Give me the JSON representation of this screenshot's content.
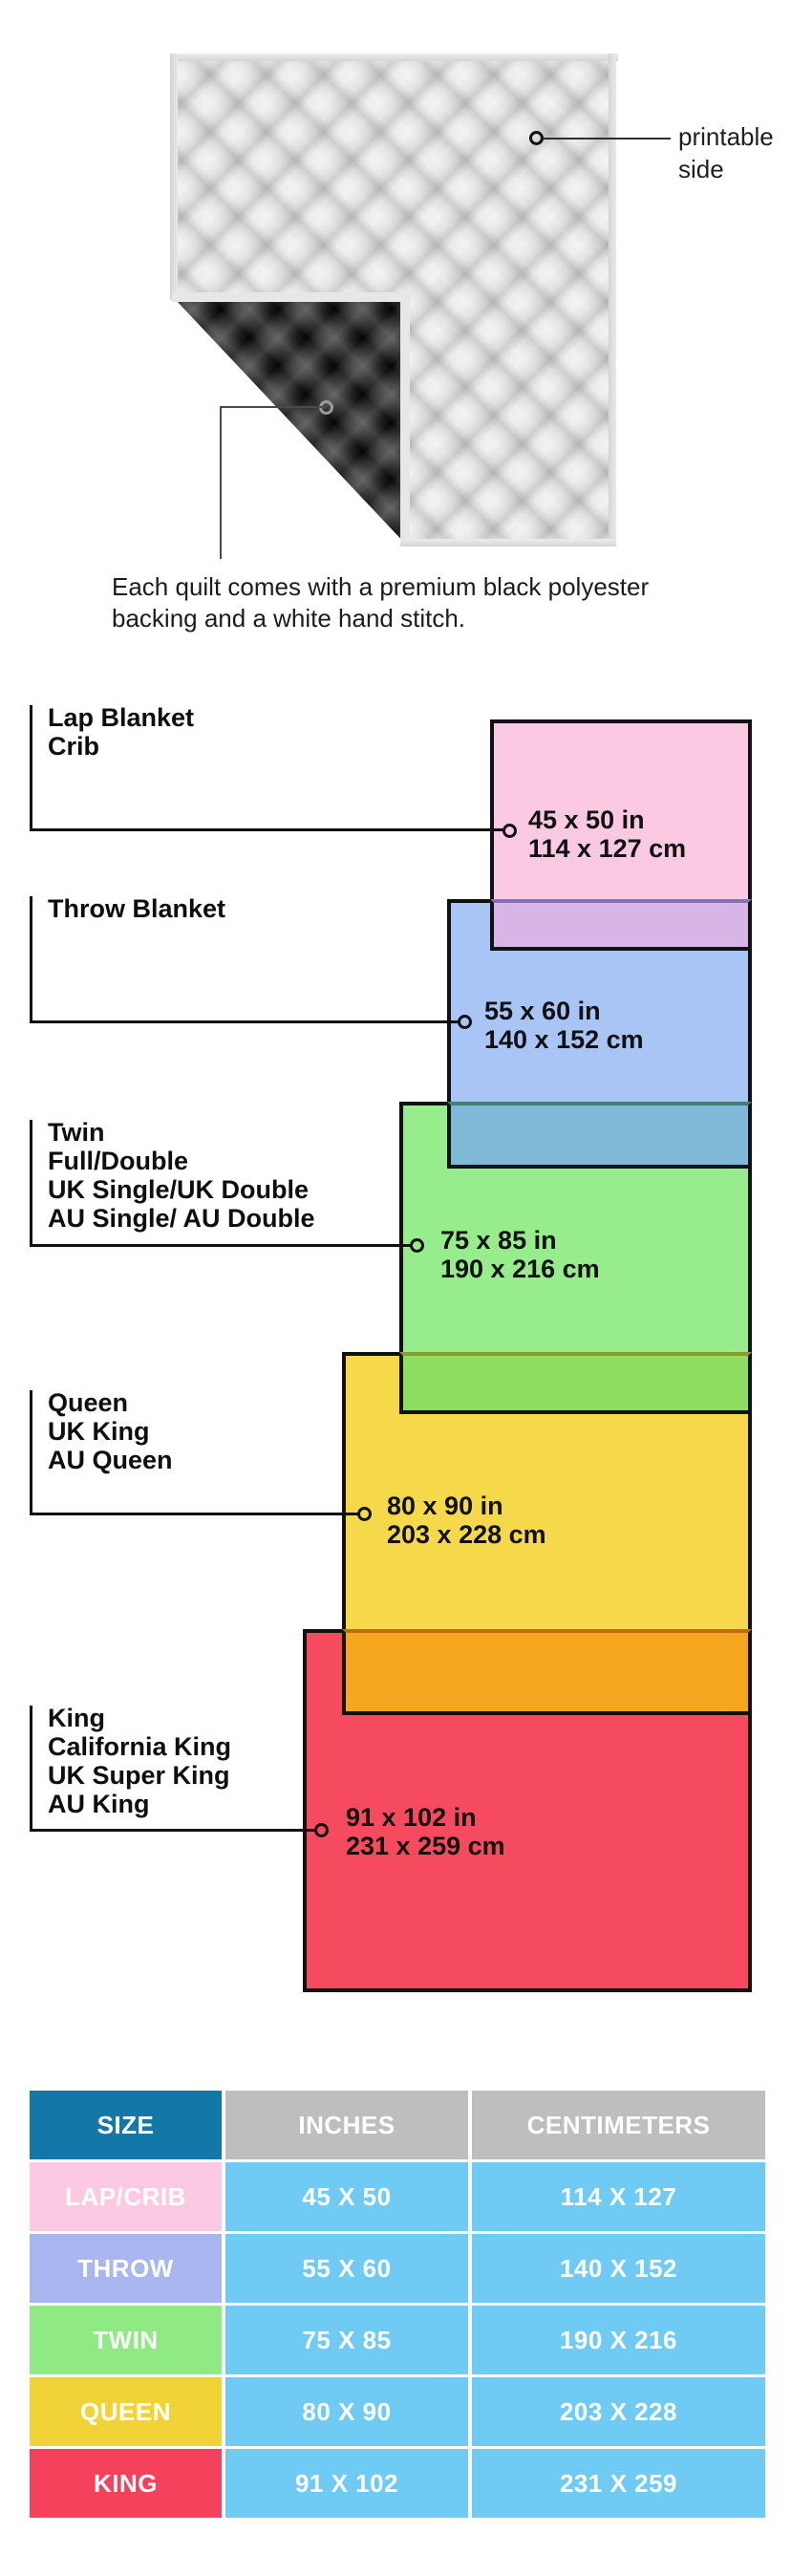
{
  "quilt_section": {
    "printable_label_line1": "printable",
    "printable_label_line2": "side",
    "caption_line1": "Each quilt comes with a premium black polyester",
    "caption_line2": "backing and a white hand stitch."
  },
  "diagram": {
    "sizes": [
      {
        "id": "lap",
        "names": [
          "Lap Blanket",
          "Crib"
        ],
        "inches": "45 x 50 in",
        "cm": "114 x 127 cm",
        "fill": "#FBC9E2",
        "overlap_fill": "#D9B4E7"
      },
      {
        "id": "throw",
        "names": [
          "Throw Blanket"
        ],
        "inches": "55 x 60 in",
        "cm": "140 x 152 cm",
        "fill": "#A8C5F6",
        "overlap_fill": "#7FB9D8"
      },
      {
        "id": "twin",
        "names": [
          "Twin",
          "Full/Double",
          "UK Single/UK Double",
          "AU Single/ AU Double"
        ],
        "inches": "75 x 85 in",
        "cm": "190 x 216 cm",
        "fill": "#97EC8C",
        "overlap_fill": "#8CDD60"
      },
      {
        "id": "queen",
        "names": [
          "Queen",
          "UK King",
          "AU Queen"
        ],
        "inches": "80 x 90 in",
        "cm": "203 x 228 cm",
        "fill": "#F6D94B",
        "overlap_fill": "#F4A61E"
      },
      {
        "id": "king",
        "names": [
          "King",
          "California King",
          "UK Super King",
          "AU King"
        ],
        "inches": "91 x 102 in",
        "cm": "231 x 259 cm",
        "fill": "#F64A5E",
        "overlap_fill": null
      }
    ]
  },
  "table": {
    "headers": [
      "SIZE",
      "INCHES",
      "CENTIMETERS"
    ],
    "header_size_color": "#1377A8",
    "header_other_color": "#BFBEBE",
    "value_cell_color": "#6FCAF4",
    "rows": [
      {
        "size": "LAP/CRIB",
        "inches": "45 X 50",
        "cm": "114 X 127",
        "color": "#FBC9E2"
      },
      {
        "size": "THROW",
        "inches": "55 X 60",
        "cm": "140 X 152",
        "color": "#A9B6F0"
      },
      {
        "size": "TWIN",
        "inches": "75 X 85",
        "cm": "190 X 216",
        "color": "#8FEA84"
      },
      {
        "size": "QUEEN",
        "inches": "80 X 90",
        "cm": "203 X 228",
        "color": "#F2D337"
      },
      {
        "size": "KING",
        "inches": "91 X 102",
        "cm": "231 X 259",
        "color": "#F5415B"
      }
    ]
  }
}
